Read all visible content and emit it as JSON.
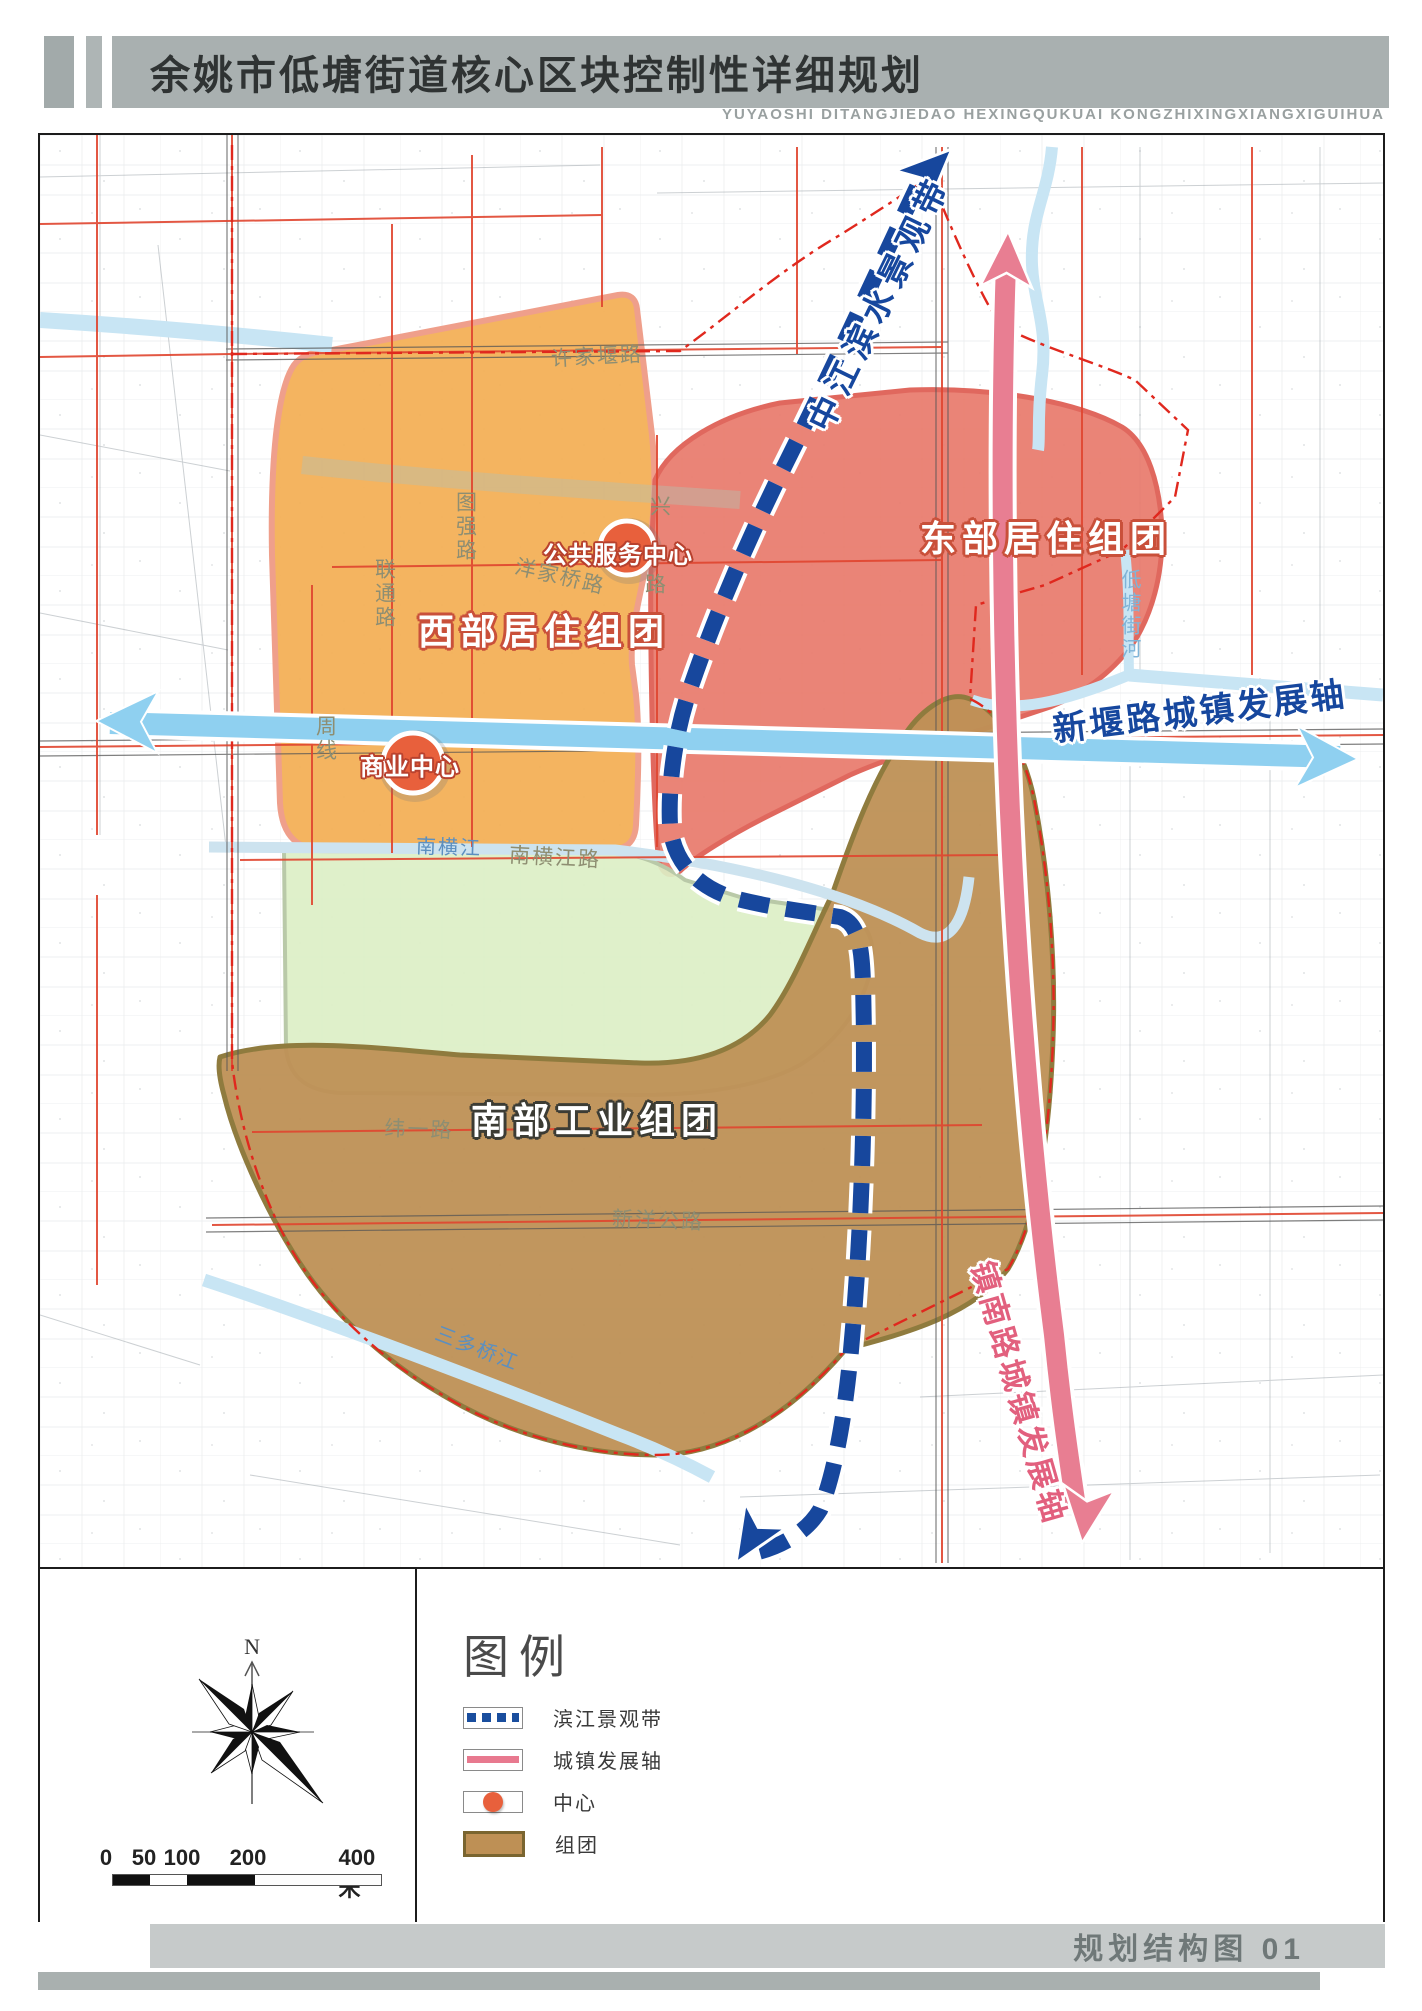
{
  "header": {
    "title": "余姚市低塘街道核心区块控制性详细规划",
    "subtitle": "YUYAOSHI DITANGJIEDAO HEXINGQUKUAI KONGZHIXINGXIANGXIGUIHUA"
  },
  "map": {
    "zone_labels": {
      "west": "西部居住组团",
      "east": "东部居住组团",
      "south": "南部工业组团"
    },
    "axis_labels": {
      "waterfront": "中江滨水景观带",
      "xinyan": "新堰路城镇发展轴",
      "zhennan": "镇南路城镇发展轴"
    },
    "center_labels": {
      "public_service": "公共服务中心",
      "commercial": "商业中心"
    },
    "road_labels": {
      "xujiayan": "许家堰路",
      "tuqiang": "图强路",
      "liantong": "联通路",
      "zhouxian": "周线",
      "yangjiaqiao": "洋家桥路",
      "xing_fragment": "兴",
      "lu_fragment": "路",
      "nanhengjiang_road": "南横江路",
      "weiyi": "纬一路",
      "xinyang_highway": "新洋公路"
    },
    "river_labels": {
      "nanhengjiang": "南横江",
      "sanduoqiao": "三多桥江",
      "ditangjie": "低塘街河"
    }
  },
  "legend": {
    "title": "图例",
    "items": [
      {
        "label": "滨江景观带",
        "symbol": "blue-dashed-line"
      },
      {
        "label": "城镇发展轴",
        "symbol": "pink-line"
      },
      {
        "label": "中心",
        "symbol": "orange-dot"
      },
      {
        "label": "组团",
        "symbol": "brown-fill"
      }
    ]
  },
  "scale_bar": {
    "labels": [
      "0",
      "50",
      "100",
      "200"
    ],
    "end_label": "400米"
  },
  "compass": {
    "north": "N"
  },
  "footer": {
    "caption": "规划结构图 01"
  },
  "colors": {
    "west_zone": "#f3ae52",
    "east_zone": "#e87a6b",
    "green_buffer": "#dcefc6",
    "south_zone": "#be9055",
    "waterfront_belt": "#17479d",
    "xinyan_axis": "#8fd0f0",
    "zhennan_axis": "#e87e92",
    "center_dot": "#e8603c",
    "boundary": "#e0281e",
    "header_band": "#a9b0b0"
  }
}
